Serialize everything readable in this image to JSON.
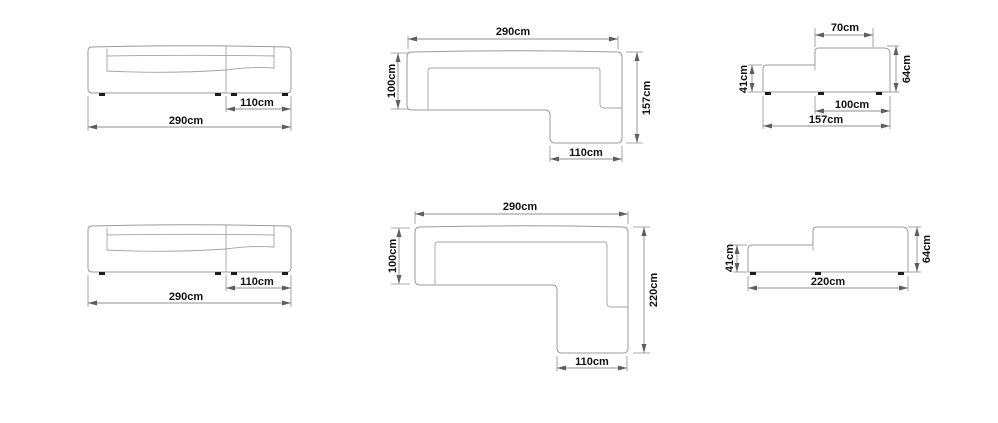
{
  "style": {
    "background": "#ffffff",
    "outline_color": "#9b9b9b",
    "dimension_line_color": "#8f8f8f",
    "arrow_color": "#5f5f5f",
    "text_color": "#111111",
    "feet_color": "#1c1c1c"
  },
  "diagrams": {
    "front_157": {
      "total_width": "290cm",
      "chaise_width": "110cm"
    },
    "top_157": {
      "total_width": "290cm",
      "depth_left": "100cm",
      "depth_right": "157cm",
      "chaise_width": "110cm"
    },
    "side_157": {
      "back_top_width": "70cm",
      "seat_height": "41cm",
      "back_height": "64cm",
      "seat_depth": "100cm",
      "total_depth": "157cm"
    },
    "front_220": {
      "total_width": "290cm",
      "chaise_width": "110cm"
    },
    "top_220": {
      "total_width": "290cm",
      "depth_left": "100cm",
      "depth_right": "220cm",
      "chaise_width": "110cm"
    },
    "side_220": {
      "seat_height": "41cm",
      "back_height": "64cm",
      "total_depth": "220cm"
    }
  }
}
